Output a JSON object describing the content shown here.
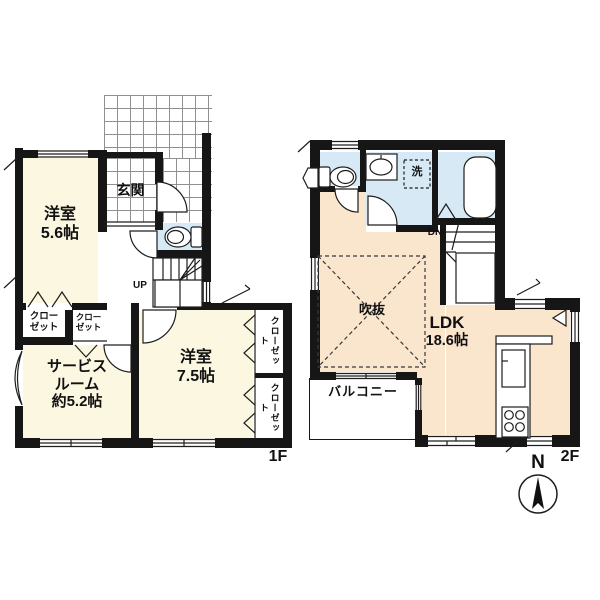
{
  "floor1": {
    "floor_label": "1F",
    "room_56": {
      "name": "洋室",
      "area": "5.6帖"
    },
    "entrance_label": "玄関",
    "service_room": {
      "line1": "サービス",
      "line2": "ルーム",
      "line3": "約5.2帖"
    },
    "room_75": {
      "name": "洋室",
      "area": "7.5帖"
    },
    "closet_left": {
      "line1": "クロー",
      "line2": "ゼット"
    },
    "closet_mid": {
      "line1": "クロー",
      "line2": "ゼット"
    },
    "closet_right_top": "クローゼット",
    "closet_right_bottom": "クローゼット",
    "stairs_label": "UP"
  },
  "floor2": {
    "floor_label": "2F",
    "ldk": {
      "name": "LDK",
      "area": "18.6帖"
    },
    "void_label": "吹抜",
    "balcony_label": "バルコニー",
    "laundry_label": "洗",
    "stairs_label": "DN"
  },
  "compass": {
    "north_label": "N"
  },
  "colors": {
    "wall": "#161616",
    "room_cream": "#FBF7E1",
    "ldk_peach": "#FAE5CD",
    "water_blue": "#D6E9F4"
  }
}
